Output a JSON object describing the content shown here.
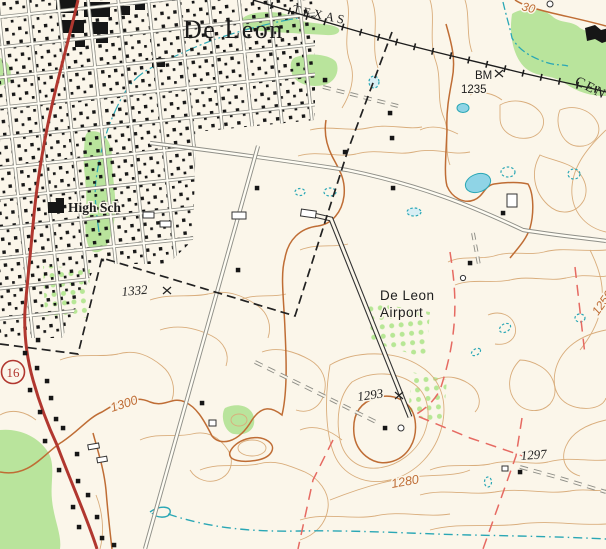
{
  "map": {
    "kind": "usgs-topographic-map",
    "background": "#fbf6ea",
    "colors": {
      "contour": "#d9ad7c",
      "contour_index": "#bf6d35",
      "water": "#2aa7b5",
      "pond_fill": "#8fd4e6",
      "woodland": "#b9e49c",
      "orchard_dot": "#b7e795",
      "highway_red": "#b1372f",
      "road_casing": "#8f8f88",
      "railroad_black": "#1d1d1d",
      "building_black": "#161616",
      "boundary_red_dash": "#e66a62",
      "label_orange": "#bf6d35"
    },
    "labels": {
      "town": "De Leon",
      "railroad_name_top": "TEXAS",
      "railroad_name_right": "CEN",
      "benchmark_abbr": "BM",
      "benchmark_elev": "1235",
      "school": "High Sch",
      "airport_line1": "De Leon",
      "airport_line2": "Airport",
      "route_shield": "16",
      "spot_elev_west": "1332",
      "spot_elev_airport_hill": "1293",
      "spot_elev_southeast": "1297",
      "contour_label_1300": "1300",
      "contour_label_1280": "1280",
      "contour_label_top_fragment": "30",
      "contour_label_right_fragment": "1250"
    }
  }
}
